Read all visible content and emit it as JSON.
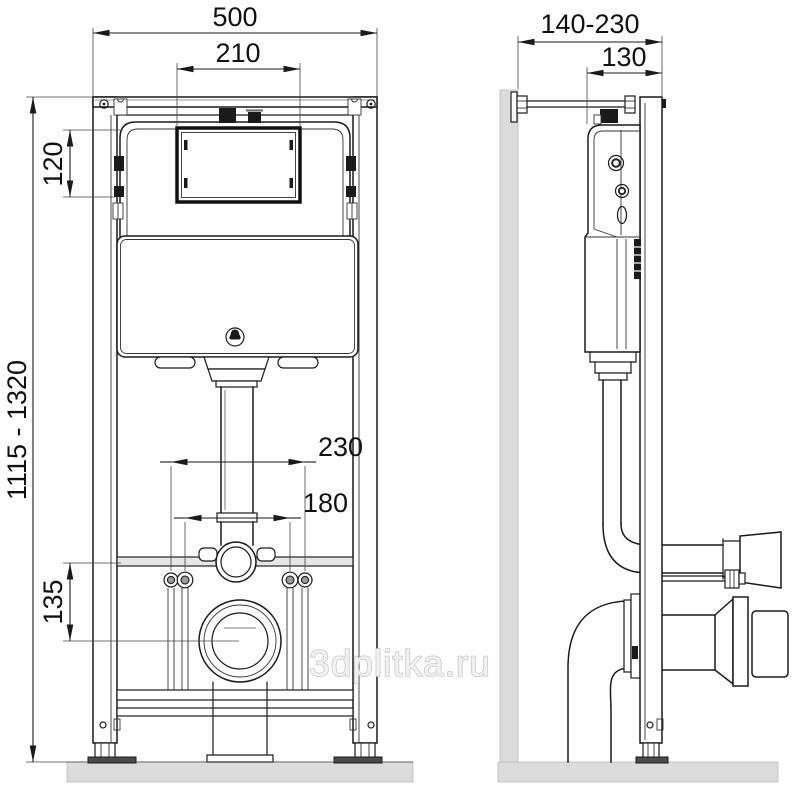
{
  "watermark": "3dplitka.ru",
  "front_view": {
    "frame_width": "500",
    "service_window_width": "210",
    "service_window_offset": "120",
    "install_height_range": "1115 - 1320",
    "fixing_spacing_outer": "230",
    "fixing_spacing_inner": "180",
    "outlet_height": "135"
  },
  "side_view": {
    "depth_range": "140-230",
    "frame_depth": "130"
  }
}
